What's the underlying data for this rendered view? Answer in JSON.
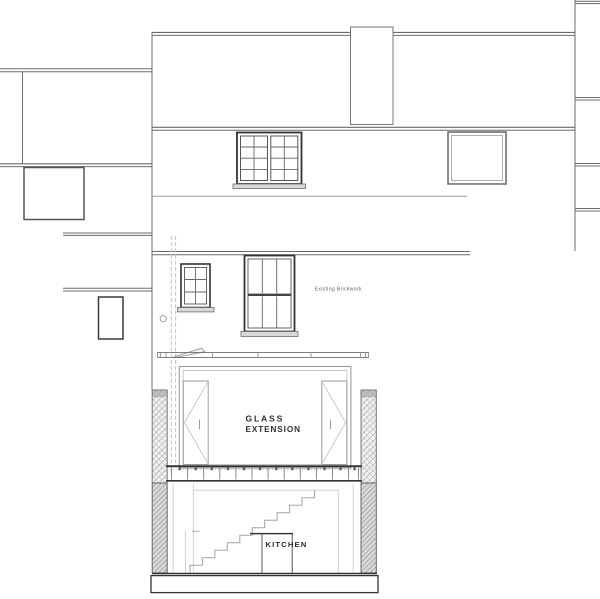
{
  "drawing": {
    "labels": {
      "existing_brickwork": "Existing Brickwork",
      "extension_line1": "GLASS",
      "extension_line2": "EXTENSION",
      "kitchen": "KITCHEN"
    },
    "colors": {
      "background": "#ffffff",
      "ink_dark": "#2f2f2f",
      "ink_mid": "#6b6b6b",
      "ink_light": "#9b9b9b",
      "ink_faint": "#c2c2c2",
      "sill_fill": "#d9d9d9",
      "hatch_bg": "#f0f0f0",
      "hatch_line": "#9a9a9a",
      "below_ground_bg": "#d8d8d8",
      "below_ground_line": "#8b8b8b"
    }
  }
}
